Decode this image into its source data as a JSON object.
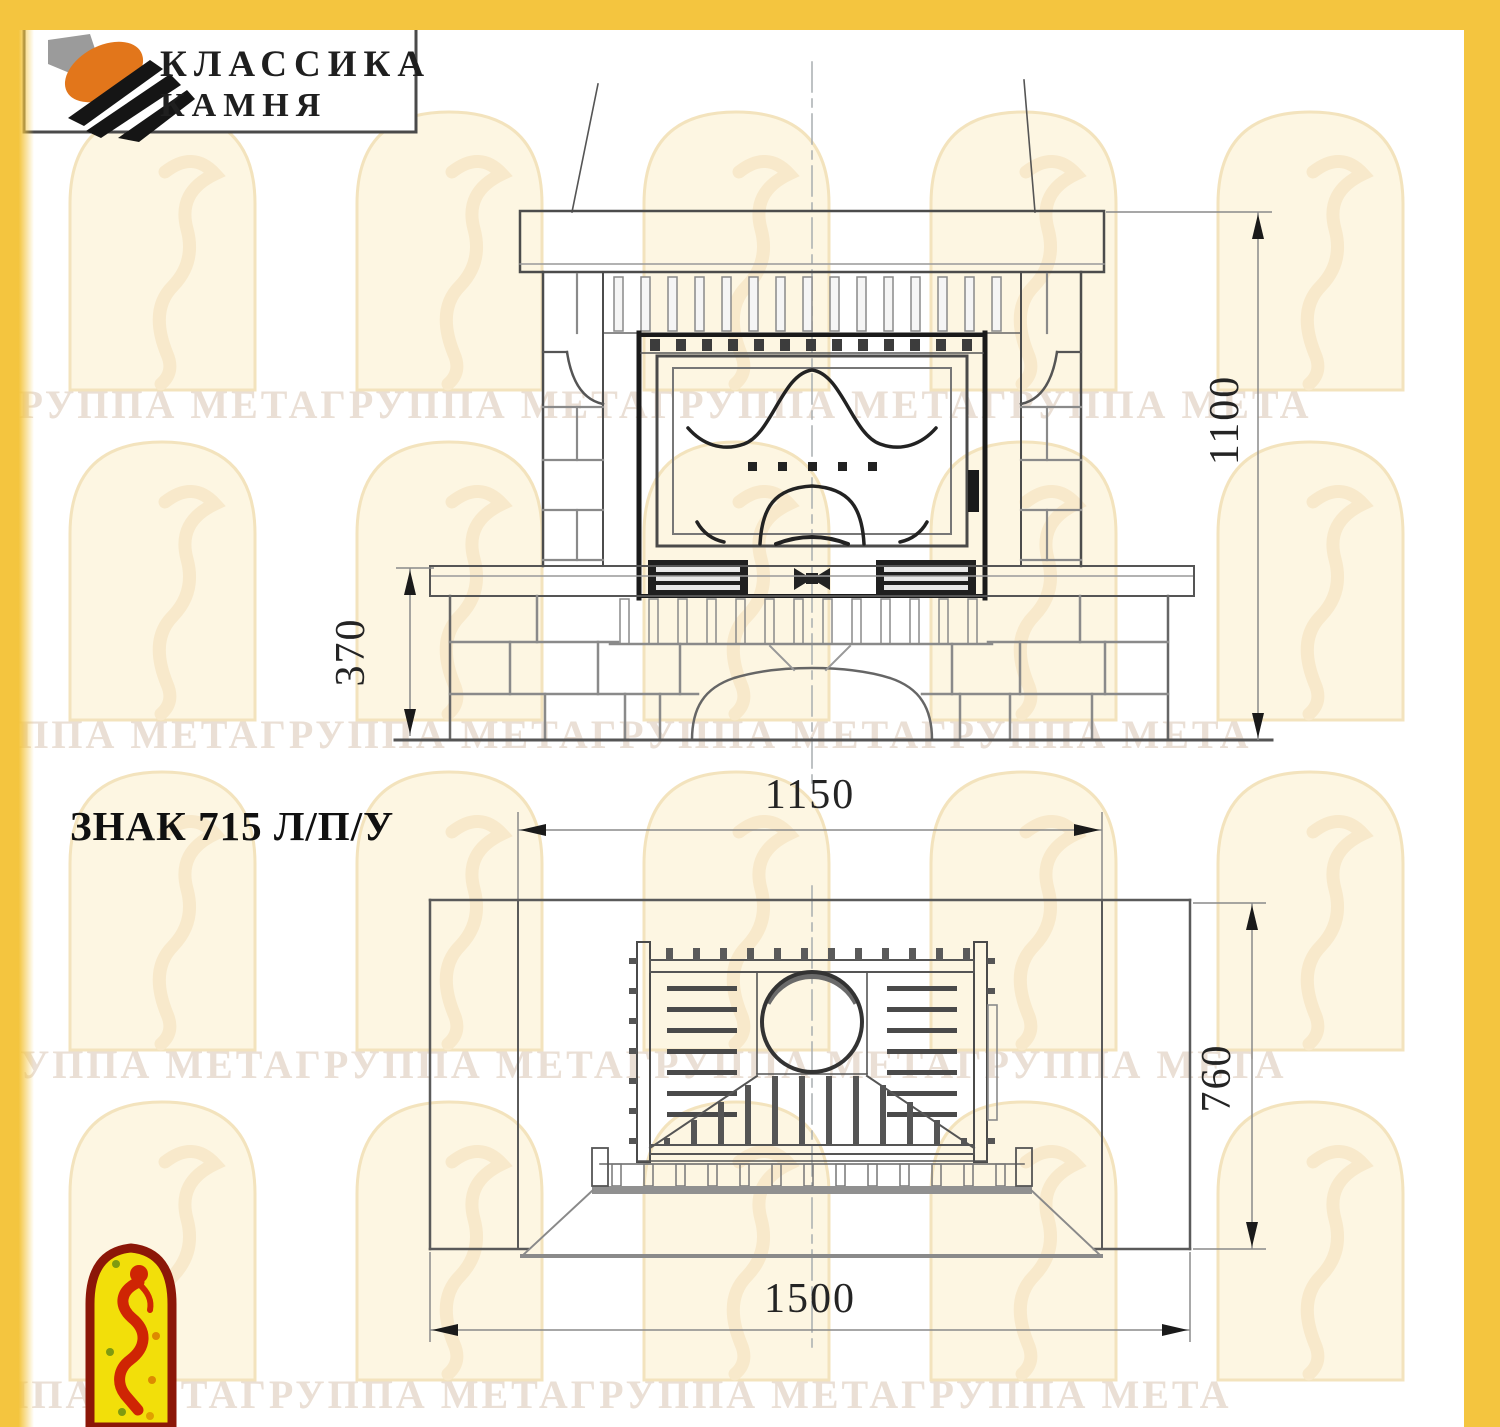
{
  "brand": {
    "name_line1": "КЛАССИКА",
    "name_line2": "КАМНЯ"
  },
  "model": {
    "title": "ЗНАК 715 Л/П/У"
  },
  "watermark": {
    "rows": [
      "ГРУППА МЕТАГРУППА МЕТАГРУППА МЕТАГРУППА МЕТА",
      "ГРУППА МЕТАГРУППА МЕТАГРУППА МЕТАГРУППА МЕТА",
      "ГРУППА МЕТАГРУППА МЕТАГРУППА МЕТАГРУППА МЕТА",
      "ГРУППА МЕТАГРУППА МЕТАГРУППА МЕТАГРУППА МЕТА"
    ]
  },
  "dimensions": {
    "total_height_mm": "1100",
    "plinth_height_mm": "370",
    "top_width_mm": "1150",
    "depth_mm": "760",
    "total_width_mm": "1500"
  },
  "colors": {
    "border_gold": "#f4c53f",
    "line_dark": "#1a1a1a",
    "line_main": "#4c4c4c",
    "line_gray": "#8a8a8a",
    "watermark_text": "#eadfd5",
    "logo_orange": "#e2761b",
    "jester_red": "#cf2504",
    "jester_yellow": "#f2df0a",
    "jester_border": "#8c1708"
  }
}
